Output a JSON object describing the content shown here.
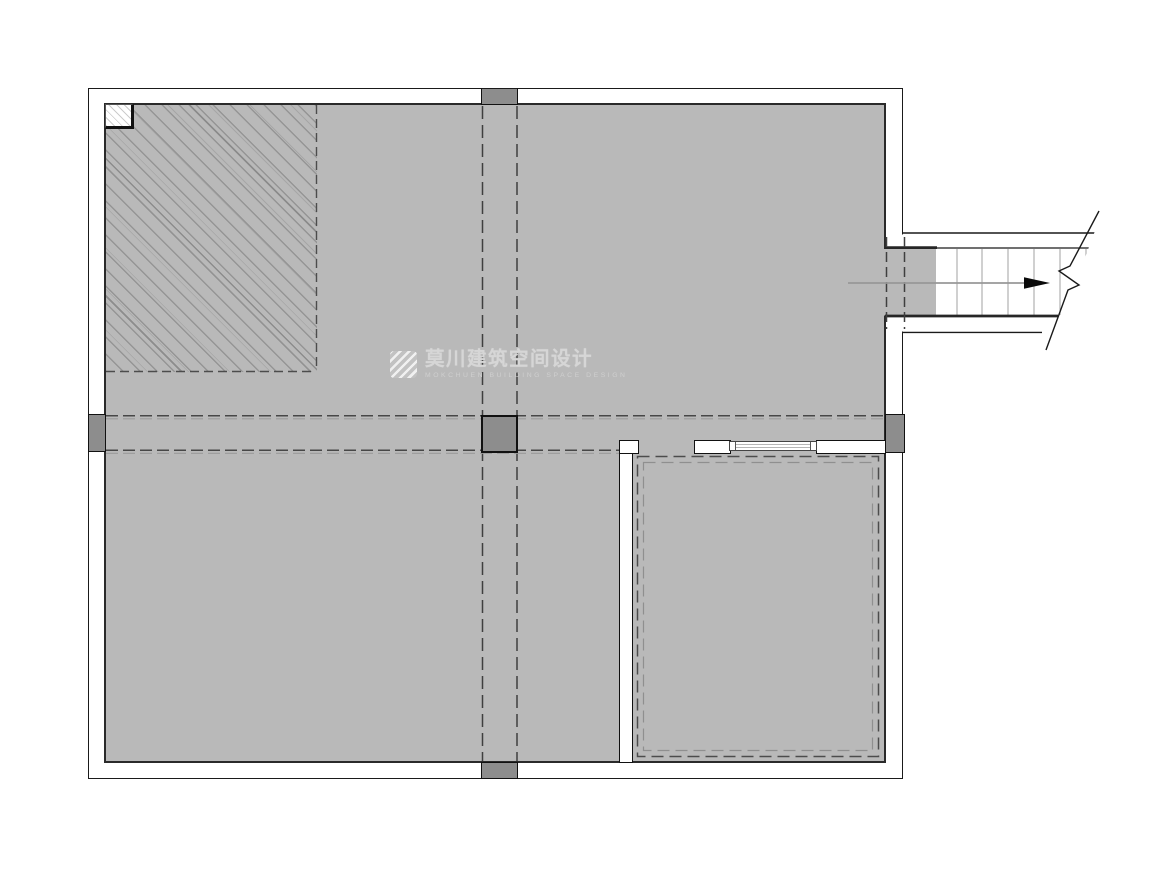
{
  "document": {
    "type": "architectural-floor-plan",
    "view": "basement / mezzanine plan with stair break line"
  },
  "watermark": {
    "logo_icon": "mokchuen-diagonal-stripes-logo",
    "title": "莫川建筑空间设计",
    "subtitle": "MOKCHUEN BUILDING SPACE DESIGN"
  },
  "plan_features": [
    "hatched-void-area-top-left",
    "corner-shaft-box",
    "column-grid-dashed-lines",
    "beam-double-dashed-lines",
    "five-structural-columns",
    "bottom-right-room-with-dashed-ceiling-outline",
    "window-sliding-track",
    "stair-corridor-with-direction-arrow-and-break-line"
  ],
  "colors": {
    "floor_fill": "#b9b9b9",
    "wall_fill": "#ffffff",
    "line": "#1a1a1a",
    "column_fill": "#8d8d8d",
    "dashed_line": "#3f3f3f",
    "tread_line": "#a9a9a9",
    "watermark_text": "#d6d6d6"
  }
}
